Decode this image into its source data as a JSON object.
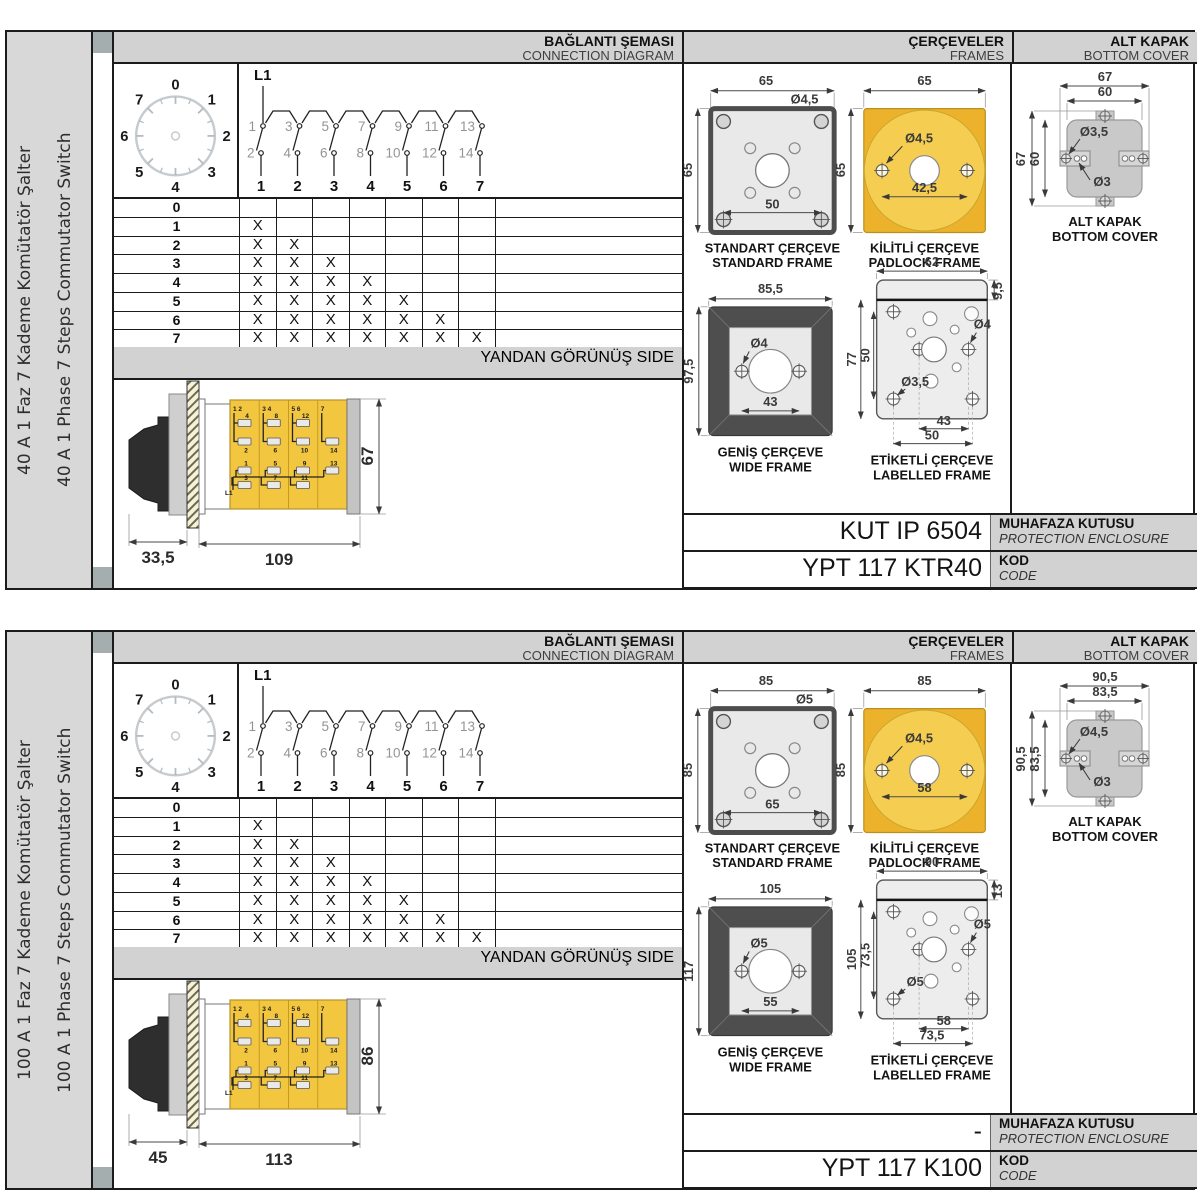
{
  "sections": [
    {
      "side_label_tr": "40 A 1 Faz 7 Kademe Komütatör Şalter",
      "side_label_en": "40 A 1 Phase 7 Steps Commutator Switch",
      "headers": {
        "connection_tr": "BAĞLANTI ŞEMASI",
        "connection_en": "CONNECTION DIAGRAM",
        "frames_tr": "ÇERÇEVELER",
        "frames_en": "FRAMES",
        "cover_tr": "ALT KAPAK",
        "cover_en": "BOTTOM COVER"
      },
      "dial": {
        "positions": [
          "0",
          "1",
          "2",
          "3",
          "4",
          "5",
          "6",
          "7"
        ]
      },
      "schematic": {
        "line_label": "L1",
        "top_terminals": [
          "1",
          "3",
          "5",
          "7",
          "9",
          "11",
          "13"
        ],
        "bottom_terminals": [
          "2",
          "4",
          "6",
          "8",
          "10",
          "12",
          "14"
        ],
        "outputs": [
          "1",
          "2",
          "3",
          "4",
          "5",
          "6",
          "7"
        ]
      },
      "step_table": {
        "mark": "X",
        "rows": [
          {
            "step": "0",
            "x_count": 0
          },
          {
            "step": "1",
            "x_count": 1
          },
          {
            "step": "2",
            "x_count": 2
          },
          {
            "step": "3",
            "x_count": 3
          },
          {
            "step": "4",
            "x_count": 4
          },
          {
            "step": "5",
            "x_count": 5
          },
          {
            "step": "6",
            "x_count": 6
          },
          {
            "step": "7",
            "x_count": 7
          }
        ]
      },
      "side_view": {
        "header_tr": "YANDAN GÖRÜNÜŞ",
        "header_en": "SIDE",
        "dim_knob": "33,5",
        "dim_body": "109",
        "dim_height": "67",
        "line_label": "L1",
        "col_headers": [
          "1 2",
          "3 4",
          "5 6",
          "7"
        ],
        "row1": [
          "4",
          "8",
          "12"
        ],
        "row2": [
          "2",
          "6",
          "10",
          "14"
        ],
        "row3": [
          "1",
          "5",
          "9",
          "13"
        ],
        "row4": [
          "3",
          "7",
          "11"
        ]
      },
      "frames": {
        "standard": {
          "tr": "STANDART ÇERÇEVE",
          "en": "STANDARD FRAME",
          "dim_w": "65",
          "dim_h": "65",
          "hole": "Ø4,5",
          "spacing": "50"
        },
        "padlock": {
          "tr": "KİLİTLİ ÇERÇEVE",
          "en": "PADLOCK FRAME",
          "dim_w": "65",
          "dim_h": "65",
          "hole": "Ø4,5",
          "spacing": "42,5"
        },
        "wide": {
          "tr": "GENİŞ ÇERÇEVE",
          "en": "WIDE FRAME",
          "dim_w": "85,5",
          "dim_h": "97,5",
          "hole": "Ø4",
          "spacing": "43"
        },
        "labelled": {
          "tr": "ETİKETLİ ÇERÇEVE",
          "en": "LABELLED FRAME",
          "dim_w": "62",
          "dim_strip": "9,5",
          "dim_h": "77",
          "dim_h_inner": "50",
          "hole_right": "Ø4",
          "hole_bottom": "Ø3,5",
          "spacing_inner": "43",
          "spacing_outer": "50"
        }
      },
      "bottom_cover": {
        "caption_tr": "ALT KAPAK",
        "caption_en": "BOTTOM COVER",
        "dim_w_outer": "67",
        "dim_w_inner": "60",
        "dim_h_outer": "67",
        "dim_h_inner": "60",
        "hole_tab": "Ø3,5",
        "hole_small": "Ø3"
      },
      "enclosure": {
        "value": "KUT IP 6504",
        "label_tr": "MUHAFAZA KUTUSU",
        "label_en": "PROTECTION ENCLOSURE"
      },
      "code": {
        "value": "YPT 117 KTR40",
        "label_tr": "KOD",
        "label_en": "CODE"
      }
    },
    {
      "side_label_tr": "100 A 1 Faz 7 Kademe Komütatör Şalter",
      "side_label_en": "100 A 1 Phase 7 Steps Commutator Switch",
      "headers": {
        "connection_tr": "BAĞLANTI ŞEMASI",
        "connection_en": "CONNECTION DIAGRAM",
        "frames_tr": "ÇERÇEVELER",
        "frames_en": "FRAMES",
        "cover_tr": "ALT KAPAK",
        "cover_en": "BOTTOM COVER"
      },
      "dial": {
        "positions": [
          "0",
          "1",
          "2",
          "3",
          "4",
          "5",
          "6",
          "7"
        ]
      },
      "schematic": {
        "line_label": "L1",
        "top_terminals": [
          "1",
          "3",
          "5",
          "7",
          "9",
          "11",
          "13"
        ],
        "bottom_terminals": [
          "2",
          "4",
          "6",
          "8",
          "10",
          "12",
          "14"
        ],
        "outputs": [
          "1",
          "2",
          "3",
          "4",
          "5",
          "6",
          "7"
        ]
      },
      "step_table": {
        "mark": "X",
        "rows": [
          {
            "step": "0",
            "x_count": 0
          },
          {
            "step": "1",
            "x_count": 1
          },
          {
            "step": "2",
            "x_count": 2
          },
          {
            "step": "3",
            "x_count": 3
          },
          {
            "step": "4",
            "x_count": 4
          },
          {
            "step": "5",
            "x_count": 5
          },
          {
            "step": "6",
            "x_count": 6
          },
          {
            "step": "7",
            "x_count": 7
          }
        ]
      },
      "side_view": {
        "header_tr": "YANDAN GÖRÜNÜŞ",
        "header_en": "SIDE",
        "dim_knob": "45",
        "dim_body": "113",
        "dim_height": "86",
        "line_label": "L1",
        "col_headers": [
          "1 2",
          "3 4",
          "5 6",
          "7"
        ],
        "row1": [
          "4",
          "8",
          "12"
        ],
        "row2": [
          "2",
          "6",
          "10",
          "14"
        ],
        "row3": [
          "1",
          "5",
          "9",
          "13"
        ],
        "row4": [
          "3",
          "7",
          "11"
        ]
      },
      "frames": {
        "standard": {
          "tr": "STANDART ÇERÇEVE",
          "en": "STANDARD FRAME",
          "dim_w": "85",
          "dim_h": "85",
          "hole": "Ø5",
          "spacing": "65"
        },
        "padlock": {
          "tr": "KİLİTLİ ÇERÇEVE",
          "en": "PADLOCK FRAME",
          "dim_w": "85",
          "dim_h": "85",
          "hole": "Ø4,5",
          "spacing": "58"
        },
        "wide": {
          "tr": "GENİŞ ÇERÇEVE",
          "en": "WIDE FRAME",
          "dim_w": "105",
          "dim_h": "117",
          "hole": "Ø5",
          "spacing": "55"
        },
        "labelled": {
          "tr": "ETİKETLİ ÇERÇEVE",
          "en": "LABELLED FRAME",
          "dim_w": "90",
          "dim_strip": "13",
          "dim_h": "105",
          "dim_h_inner": "73,5",
          "hole_right": "Ø5",
          "hole_bottom": "Ø5",
          "spacing_inner": "58",
          "spacing_outer": "73,5"
        }
      },
      "bottom_cover": {
        "caption_tr": "ALT KAPAK",
        "caption_en": "BOTTOM COVER",
        "dim_w_outer": "90,5",
        "dim_w_inner": "83,5",
        "dim_h_outer": "90,5",
        "dim_h_inner": "83,5",
        "hole_tab": "Ø4,5",
        "hole_small": "Ø3"
      },
      "enclosure": {
        "value": "-",
        "label_tr": "MUHAFAZA KUTUSU",
        "label_en": "PROTECTION ENCLOSURE"
      },
      "code": {
        "value": "YPT 117 K100",
        "label_tr": "KOD",
        "label_en": "CODE"
      }
    }
  ]
}
